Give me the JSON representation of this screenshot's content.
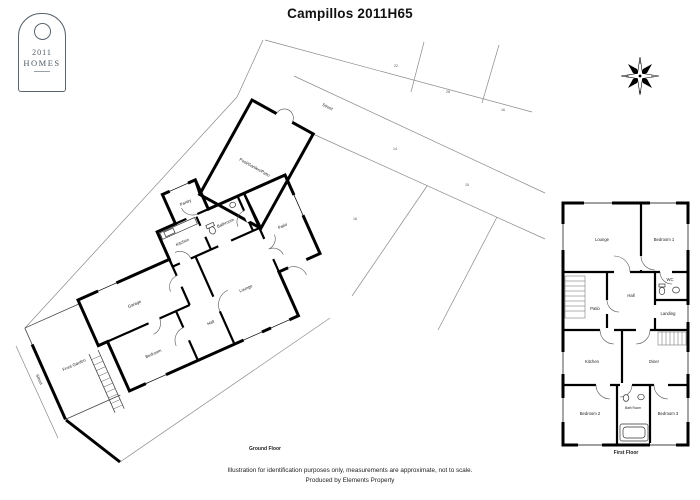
{
  "title": "Campillos 2011H65",
  "logo": {
    "year": "2011",
    "name": "HOMES"
  },
  "compass": {
    "top": "S",
    "right": "E",
    "bottom": "N",
    "left": "W"
  },
  "ground_floor": {
    "caption": "Ground Floor",
    "labels": {
      "pool": "Pool/Garden/Patio",
      "pantry": "Pantry",
      "kitchen": "Kitchen",
      "bathroom": "Bathroom",
      "patio": "Patio",
      "lounge": "Lounge",
      "garage": "Garage",
      "hall": "Hall",
      "bedroom": "Bedroom",
      "front_garden": "Front Garden",
      "street_left": "Street",
      "street_top": "Street"
    },
    "parcels": {
      "n22": "22",
      "n28": "28",
      "n16": "16",
      "n14": "14",
      "n15": "15",
      "n18": "18"
    }
  },
  "first_floor": {
    "caption": "First Floor",
    "labels": {
      "lounge": "Lounge",
      "bedroom1": "Bedroom 1",
      "patio": "Patio",
      "hall": "Hall",
      "wc": "WC",
      "landing": "Landing",
      "kitchen": "Kitchen",
      "diner": "Diner",
      "bedroom2": "Bedroom 2",
      "bathroom": "Bath Room",
      "bedroom3": "Bedroom 3"
    }
  },
  "footer": {
    "line1": "Illustration for identification purposes only, measurements are approximate, not to scale.",
    "line2": "Produced by Elements Property"
  }
}
